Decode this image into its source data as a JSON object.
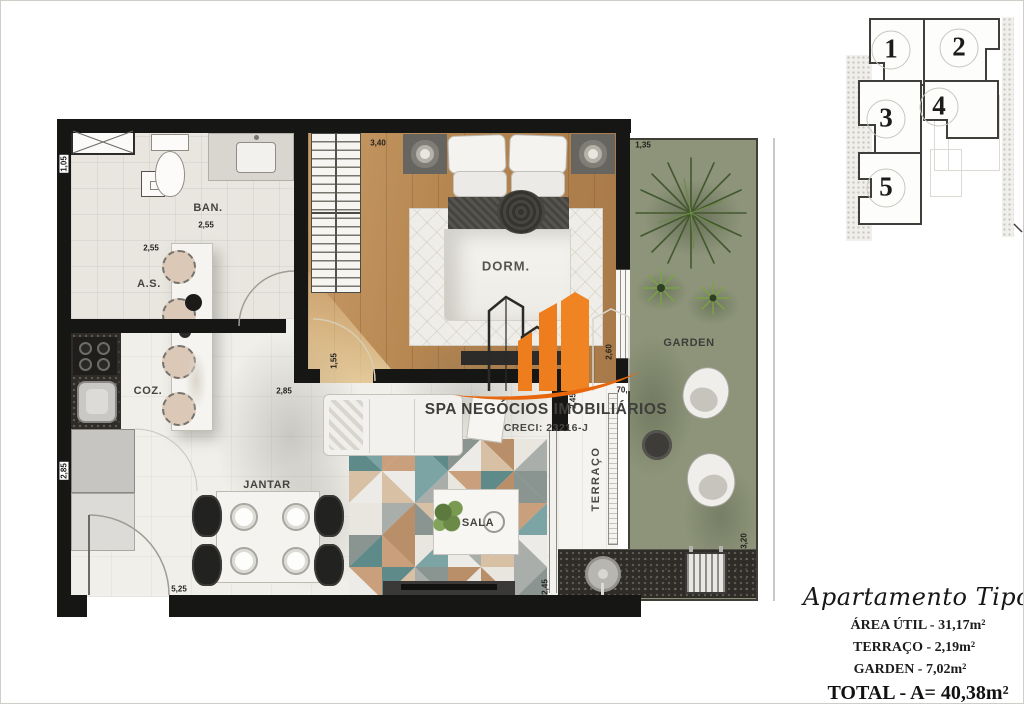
{
  "watermark": {
    "name": "SPA NEGÓCIOS IMOBILIÁRIOS",
    "creci": "CRECI: 23216-J"
  },
  "plan": {
    "rooms": {
      "ban": "BAN.",
      "as": "A.S.",
      "coz": "COZ.",
      "dorm": "DORM.",
      "jantar": "JANTAR",
      "sala": "SALA",
      "terraco": "TERRAÇO",
      "garden": "GARDEN"
    },
    "dims": {
      "ban_left": "1,05",
      "ban_width": "2,55",
      "as_width": "2,55",
      "coz_left": "2,85",
      "bottom_width": "5,25",
      "dorm_width": "3,40",
      "dorm_door": "1,55",
      "dorm_bottom": "2,85",
      "dorm_right": "2,60",
      "terraco_top": "70,",
      "terraco_side": "2,45",
      "sala_side": "2,45",
      "garden_top": "1,35",
      "garden_side": "3,20"
    }
  },
  "keyplan": {
    "units": [
      "1",
      "2",
      "3",
      "4",
      "5"
    ]
  },
  "summary": {
    "title": "Apartamento Tipo 02 - Gara",
    "area_util": "ÁREA ÚTIL - 31,17m²",
    "terraco": "TERRAÇO - 2,19m²",
    "garden": "GARDEN - 7,02m²",
    "total": "TOTAL - A= 40,38m²"
  },
  "colors": {
    "accent_orange": "#ED7A1E",
    "wall_black": "#161614",
    "grass_green": "#8C9378",
    "wood_tan": "#B5854F",
    "rug_palette": [
      "#7ca4a4",
      "#e9e5df",
      "#c9a07b",
      "#a9aeab",
      "#5f8a8a",
      "#d8c0a5",
      "#8a9491",
      "#ecebe7",
      "#b98f69"
    ]
  }
}
